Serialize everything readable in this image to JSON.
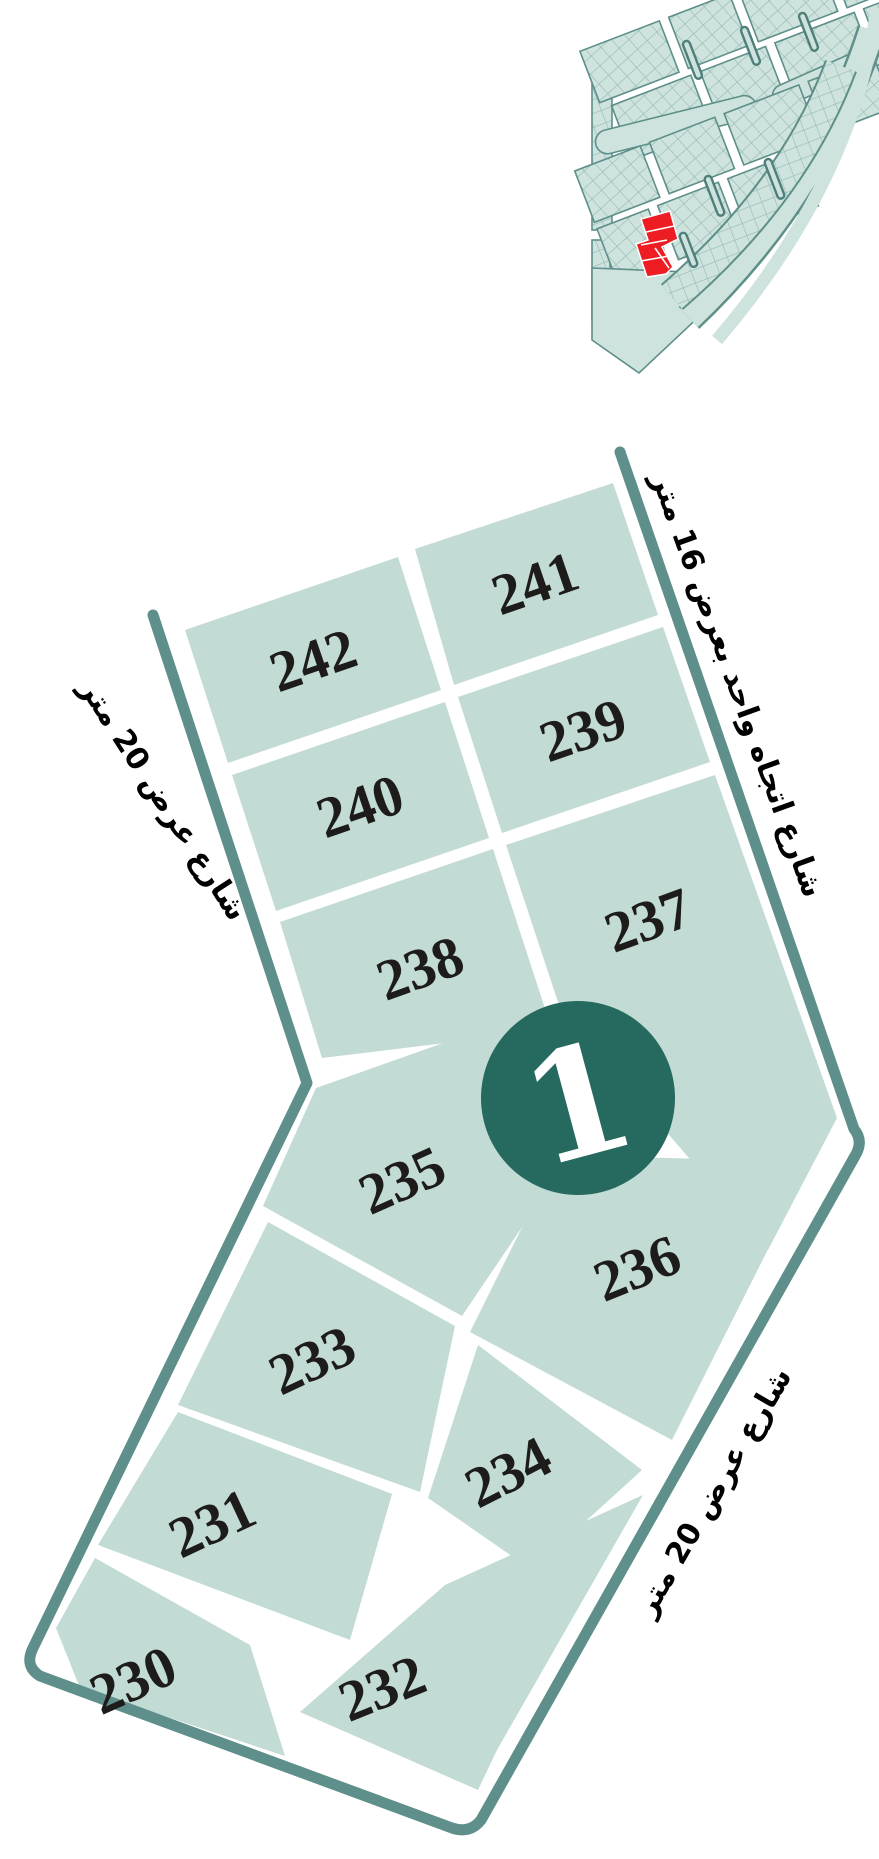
{
  "map": {
    "region_badge": "1",
    "colors": {
      "plot_fill": "#c2dbd5",
      "road_border": "#5e8f8a",
      "badge_circle": "#25695f",
      "highlight_red": "#ee1d23",
      "label_text": "#1d1c1a"
    },
    "plots": [
      {
        "number": "242",
        "points": "185,630 398,557 441,690 228,763",
        "lx": 313,
        "ly": 660,
        "rot": -19
      },
      {
        "number": "241",
        "points": "415,549 613,483 658,615 454,685",
        "lx": 535,
        "ly": 583,
        "rot": -19
      },
      {
        "number": "240",
        "points": "232,775 445,702 489,838 276,911",
        "lx": 360,
        "ly": 806,
        "rot": -19
      },
      {
        "number": "239",
        "points": "458,697 663,627 710,762 502,833",
        "lx": 583,
        "ly": 730,
        "rot": -19
      },
      {
        "number": "238",
        "points": "280,922 493,849 552,1030 322,1058",
        "lx": 420,
        "ly": 968,
        "rot": -20
      },
      {
        "number": "237",
        "points": "506,845 715,775 837,1118 768,1250 560,1008",
        "lx": 648,
        "ly": 920,
        "rot": -20
      },
      {
        "number": "235",
        "points": "316,1088 520,1016 562,1168 462,1316 263,1206",
        "lx": 402,
        "ly": 1180,
        "rot": -24
      },
      {
        "number": "236",
        "points": "558,1155 812,1162 672,1440 470,1332",
        "lx": 637,
        "ly": 1268,
        "rot": -22
      },
      {
        "number": "233",
        "points": "268,1222 455,1326 420,1492 178,1405",
        "lx": 312,
        "ly": 1360,
        "rot": -25
      },
      {
        "number": "234",
        "points": "478,1345 642,1470 532,1570 428,1498",
        "lx": 508,
        "ly": 1472,
        "rot": -27
      },
      {
        "number": "231",
        "points": "178,1412 392,1494 350,1640 98,1545",
        "lx": 212,
        "ly": 1523,
        "rot": -25
      },
      {
        "number": "230",
        "points": "95,1558 250,1645 285,1756 80,1688 56,1628",
        "lx": 133,
        "ly": 1680,
        "rot": -24
      },
      {
        "number": "232",
        "points": "445,1585 643,1495 497,1750 478,1790 300,1712",
        "lx": 382,
        "ly": 1688,
        "rot": -22
      }
    ],
    "streets": [
      {
        "id": "street-left",
        "label": "شارع عرض 20 متر",
        "x": 163,
        "y": 800,
        "rot": 57
      },
      {
        "id": "street-right-top",
        "label": "شارع اتجاه واحد بعرض 16 متر",
        "x": 737,
        "y": 685,
        "rot": 70
      },
      {
        "id": "street-right-bottom",
        "label": "شارع عرض 20 متر",
        "x": 714,
        "y": 1492,
        "rot": -60
      }
    ],
    "border_path": "M 153,615 L 307,1083 L 33,1648 Q 24,1666 40,1676 L 452,1828 Q 470,1834 481,1820 L 855,1156 Q 864,1141 854,1129 L 620,452"
  },
  "overview": {
    "highlight_color": "#ee1d23"
  }
}
